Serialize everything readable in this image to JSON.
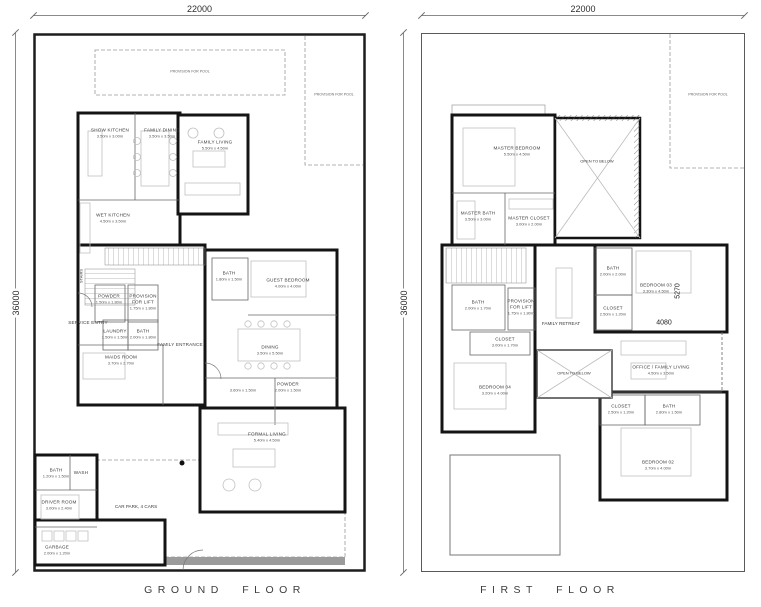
{
  "ground": {
    "title": "GROUND FLOOR",
    "dim_width": "22000",
    "dim_height": "36000",
    "pool_label": "PROVISION FOR POOL",
    "pool_side_label": "PROVISION FOR POOL",
    "stairs_label": "STAIRS",
    "carpark_label": "CAR PARK, 4 CARS",
    "rooms": {
      "show_kitchen": {
        "name": "SHOW KITCHEN",
        "dims": "3.50m x 3.00m"
      },
      "family_dining": {
        "name": "FAMILY DINING",
        "dims": "3.50m x 3.50m"
      },
      "family_living": {
        "name": "FAMILY LIVING",
        "dims": "5.50m x 4.50m"
      },
      "wet_kitchen": {
        "name": "WET KITCHEN",
        "dims": "4.50m x 3.50m"
      },
      "powder1": {
        "name": "POWDER",
        "dims": "1.50m x 1.80m"
      },
      "lift": {
        "name": "PROVISION FOR LIFT",
        "dims": "1.75m x 1.80m"
      },
      "service_entry": {
        "name": "SERVICE ENTRY",
        "dims": ""
      },
      "laundry": {
        "name": "LAUNDRY",
        "dims": "1.50m x 1.50m"
      },
      "maid_bath": {
        "name": "BATH",
        "dims": "2.00m x 1.80m"
      },
      "maids_room": {
        "name": "MAIDS ROOM",
        "dims": "3.70m x 2.70m"
      },
      "guest_bath": {
        "name": "BATH",
        "dims": "1.80m x 1.50m"
      },
      "guest_bedroom": {
        "name": "GUEST BEDROOM",
        "dims": "4.00m x 4.00m"
      },
      "family_entrance": {
        "name": "FAMILY ENTRANCE",
        "dims": ""
      },
      "dining": {
        "name": "DINING",
        "dims": "3.50m x 5.50m"
      },
      "foyer": {
        "name": "",
        "dims": "3.60m x 1.50m"
      },
      "powder2": {
        "name": "POWDER",
        "dims": "2.00m x 1.50m"
      },
      "formal_living": {
        "name": "FORMAL LIVING",
        "dims": "5.40m x 4.50m"
      },
      "bath_service": {
        "name": "BATH",
        "dims": "1.20m x 1.50m"
      },
      "wash": {
        "name": "WASH",
        "dims": ""
      },
      "driver_room": {
        "name": "DRIVER ROOM",
        "dims": "3.00m x 2.40m"
      },
      "garbage": {
        "name": "GARBAGE",
        "dims": "2.00m x 1.20m"
      }
    }
  },
  "first": {
    "title": "FIRST FLOOR",
    "dim_width": "22000",
    "dim_height": "36000",
    "pool_side_label": "PROVISION FOR POOL",
    "open_below_1": "OPEN TO BELOW",
    "open_below_2": "OPEN TO BELOW",
    "family_retreat": "FAMILY RETREAT",
    "dim_5270": "5270",
    "dim_4080": "4080",
    "rooms": {
      "master_bedroom": {
        "name": "MASTER BEDROOM",
        "dims": "5.50m x 4.50m"
      },
      "master_bath": {
        "name": "MASTER BATH",
        "dims": "3.50m x 3.00m"
      },
      "master_closet": {
        "name": "MASTER CLOSET",
        "dims": "3.00m x 2.00m"
      },
      "bath4": {
        "name": "BATH",
        "dims": "2.00m x 1.70m"
      },
      "lift": {
        "name": "PROVISION FOR LIFT",
        "dims": "1.75m x 1.80m"
      },
      "closet4": {
        "name": "CLOSET",
        "dims": "3.00m x 1.70m"
      },
      "bedroom4": {
        "name": "BEDROOM 04",
        "dims": "3.20m x 4.00m"
      },
      "bath3": {
        "name": "BATH",
        "dims": "2.00m x 2.00m"
      },
      "closet3": {
        "name": "CLOSET",
        "dims": "2.50m x 1.20m"
      },
      "bedroom3": {
        "name": "BEDROOM 03",
        "dims": "3.30m x 4.50m"
      },
      "office": {
        "name": "OFFICE / FAMILY LIVING",
        "dims": "4.50m x 3.50m"
      },
      "closet2": {
        "name": "CLOSET",
        "dims": "2.50m x 1.20m"
      },
      "bath2": {
        "name": "BATH",
        "dims": "2.80m x 1.50m"
      },
      "bedroom2": {
        "name": "BEDROOM 02",
        "dims": "3.70m x 4.00m"
      }
    }
  }
}
